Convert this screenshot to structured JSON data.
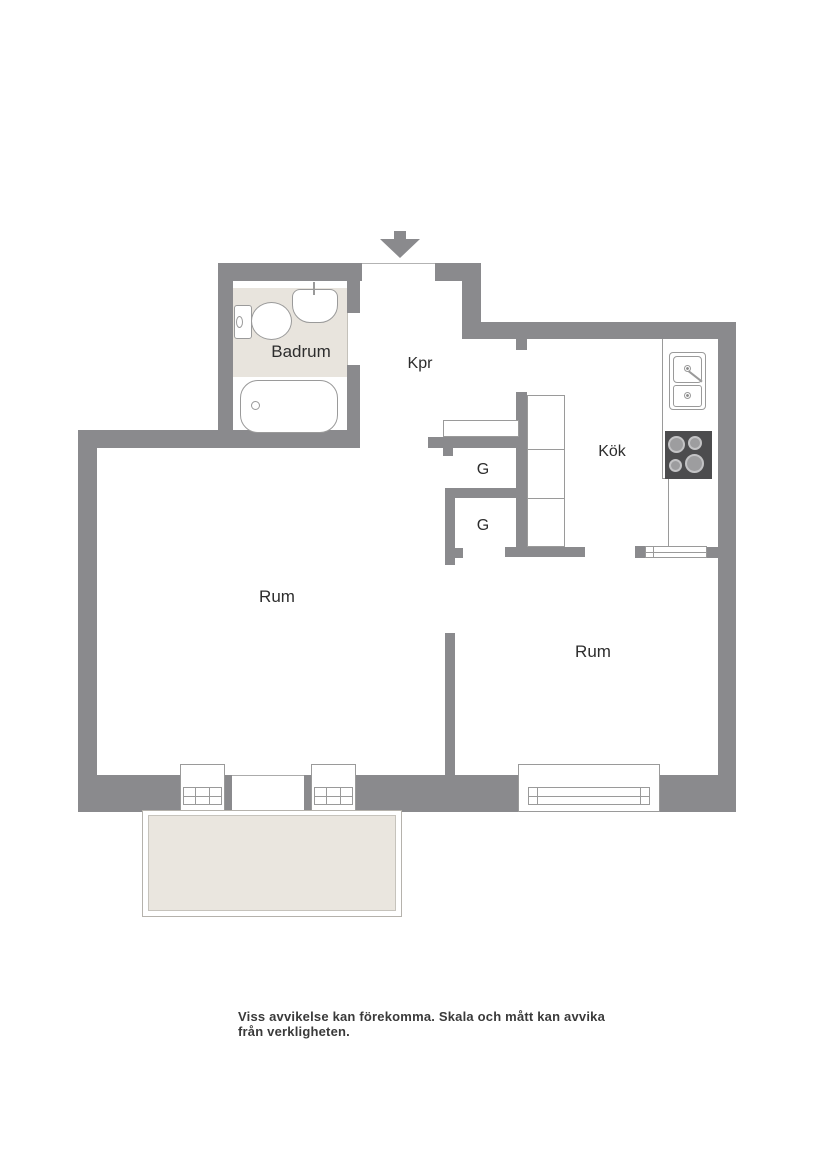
{
  "floorplan": {
    "rooms": {
      "badrum": {
        "label": "Badrum"
      },
      "kpr": {
        "label": "Kpr"
      },
      "kok": {
        "label": "Kök"
      },
      "rum_left": {
        "label": "Rum"
      },
      "rum_right": {
        "label": "Rum"
      },
      "g_upper": {
        "label": "G"
      },
      "g_lower": {
        "label": "G"
      }
    },
    "fixtures": [
      "entrance-arrow",
      "toilet",
      "bathroom-sink",
      "bathtub",
      "kitchen-sink",
      "stove",
      "wardrobe-cabinets",
      "balcony-doors",
      "window",
      "radiator",
      "balcony"
    ],
    "caption": "Viss avvikelse kan förekomma. Skala och mått kan avvika från verkligheten."
  },
  "colors": {
    "wall": "#8a8a8d",
    "line": "#9a9a9a",
    "bath_floor": "#e8e4dd",
    "balcony_floor": "#eae6df",
    "stove": "#4c4c4e",
    "burner_ring": "#c3c3c5",
    "burner_center": "#9d9d9f",
    "label": "#2d2d2d",
    "caption": "#3a3a3a"
  }
}
